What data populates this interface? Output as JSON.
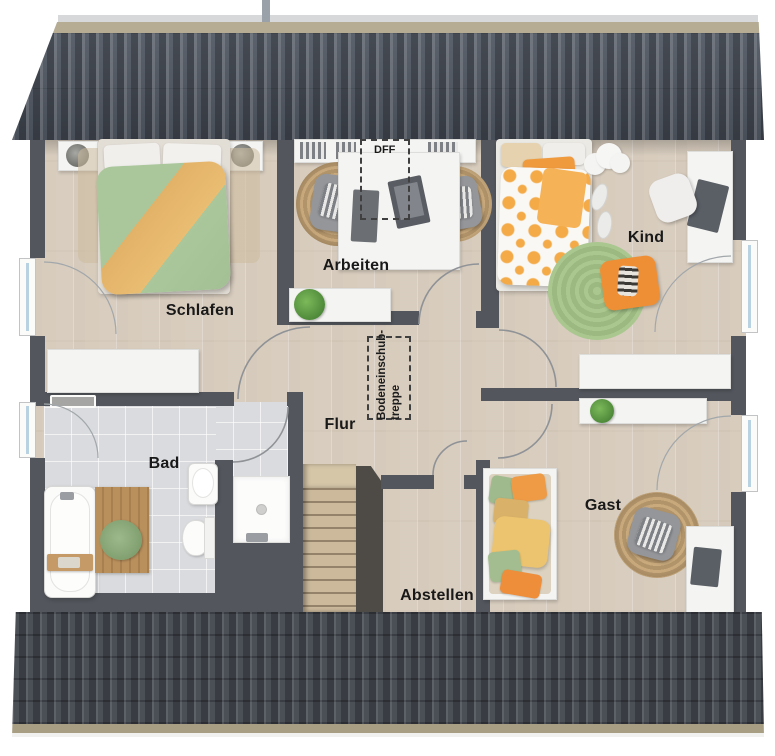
{
  "floorplan": {
    "title": "Dachgeschoss-Grundriss",
    "rooms": [
      {
        "id": "schlafen",
        "label": "Schlafen"
      },
      {
        "id": "arbeiten",
        "label": "Arbeiten"
      },
      {
        "id": "kind",
        "label": "Kind"
      },
      {
        "id": "flur",
        "label": "Flur"
      },
      {
        "id": "bad",
        "label": "Bad"
      },
      {
        "id": "abstellen",
        "label": "Abstellen"
      },
      {
        "id": "gast",
        "label": "Gast"
      }
    ],
    "annotations": [
      {
        "id": "dff",
        "label": "DFF"
      },
      {
        "id": "bodeneinschubtreppe",
        "lines": [
          "Bodeneinschub-",
          "treppe"
        ]
      }
    ],
    "colors": {
      "roof_top": "#4c535e",
      "roof_bottom": "#454a52",
      "ridge_cap": "#b5ac93",
      "eave_strip": "#a89e84",
      "wall": "#53575d",
      "floor_wood": "#dcd2c5",
      "floor_tile": "#d9dbde",
      "accent_green": "#a9c79b",
      "accent_orange": "#e8a953",
      "rug_jute": "#c3a478",
      "rug_green": "#a6c48e",
      "furniture_white": "#f4f4f2"
    }
  }
}
